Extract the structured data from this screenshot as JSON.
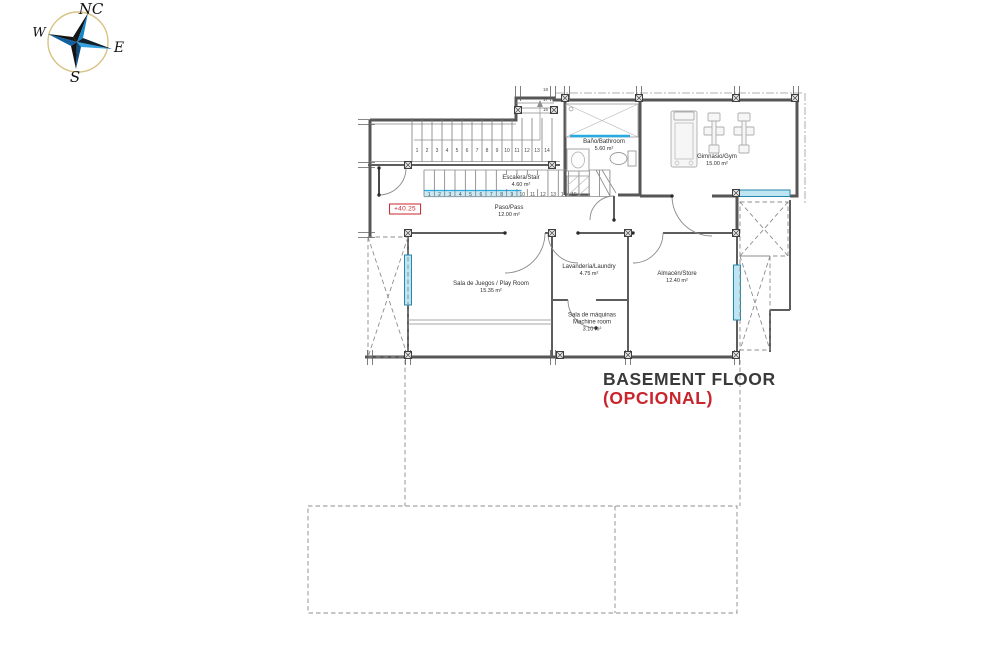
{
  "compass": {
    "north": "NC",
    "west": "W",
    "east": "E",
    "south": "S"
  },
  "floor_title": {
    "name": "BASEMENT FLOOR",
    "qualifier": "(OPCIONAL)"
  },
  "elevation_marker": {
    "value": "+40.25"
  },
  "rooms": [
    {
      "id": "bathroom",
      "name": "Baño/Bathroom",
      "area": "5.60 m²"
    },
    {
      "id": "gym",
      "name": "Gimnasio/Gym",
      "area": "15.00 m²"
    },
    {
      "id": "stair",
      "name": "Escalera/Stair",
      "area": "4.60 m²"
    },
    {
      "id": "hall",
      "name": "Paso/Pass",
      "area": "12.00 m²"
    },
    {
      "id": "playroom",
      "name": "Sala de Juegos / Play Room",
      "area": "15.35 m²"
    },
    {
      "id": "laundry",
      "name": "Lavandería/Laundry",
      "area": "4.75 m²"
    },
    {
      "id": "machine",
      "name": "Sala de máquinas",
      "name2": "Machine room",
      "area": "3.10 m²"
    },
    {
      "id": "store",
      "name": "Almacén/Store",
      "area": "12.40 m²"
    }
  ],
  "stairs": {
    "flight1_numbers": [
      "1",
      "2",
      "3",
      "4",
      "5",
      "6",
      "7",
      "8",
      "9",
      "10",
      "11",
      "12",
      "13",
      "14"
    ],
    "flight2_numbers": [
      "1",
      "2",
      "3",
      "4",
      "5",
      "6",
      "7",
      "8",
      "9",
      "10",
      "11",
      "12",
      "13",
      "14",
      "15"
    ],
    "flight2_highlight_count": 9,
    "corner_numbers_top_to_bottom": [
      "18",
      "17",
      "16"
    ]
  },
  "colors": {
    "accent_red": "#c9252c",
    "window_blue": "#29abe2",
    "compass_blue": "#1586c8",
    "title_gray": "#3a3a3a"
  },
  "icons": [
    "compass-rose-icon",
    "shower-icon",
    "toilet-icon",
    "sink-icon",
    "treadmill-icon",
    "exercise-bike-icon"
  ]
}
